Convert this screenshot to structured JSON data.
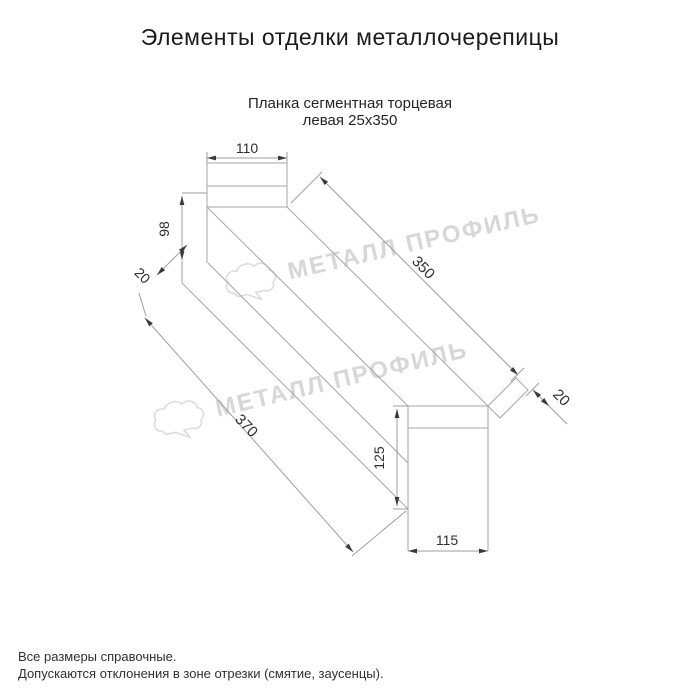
{
  "page": {
    "title": "Элементы отделки металлочерепицы",
    "subtitle_line1": "Планка сегментная торцевая",
    "subtitle_line2": "левая 25х350",
    "notes_line1": "Все размеры справочные.",
    "notes_line2": "Допускаются отклонения в зоне отрезки (смятие, заусенцы)."
  },
  "product": {
    "name": "Планка сегментная торцевая левая",
    "size": "25х350"
  },
  "drawing": {
    "type": "dimensioned technical sketch of metal roofing end trim strip",
    "dims": {
      "d110": "110",
      "d98": "98",
      "d20_left": "20",
      "d350": "350",
      "d20_right": "20",
      "d370": "370",
      "d125": "125",
      "d115": "115"
    }
  },
  "watermark": {
    "text": "МЕТАЛЛ ПРОФИЛЬ",
    "logo": "cloud-logo"
  },
  "colors": {
    "line": "#a6a6a6",
    "dim_text": "#2e2e2e",
    "arrow": "#3a3a3a",
    "watermark": "#d7d7d7",
    "background": "#ffffff"
  }
}
